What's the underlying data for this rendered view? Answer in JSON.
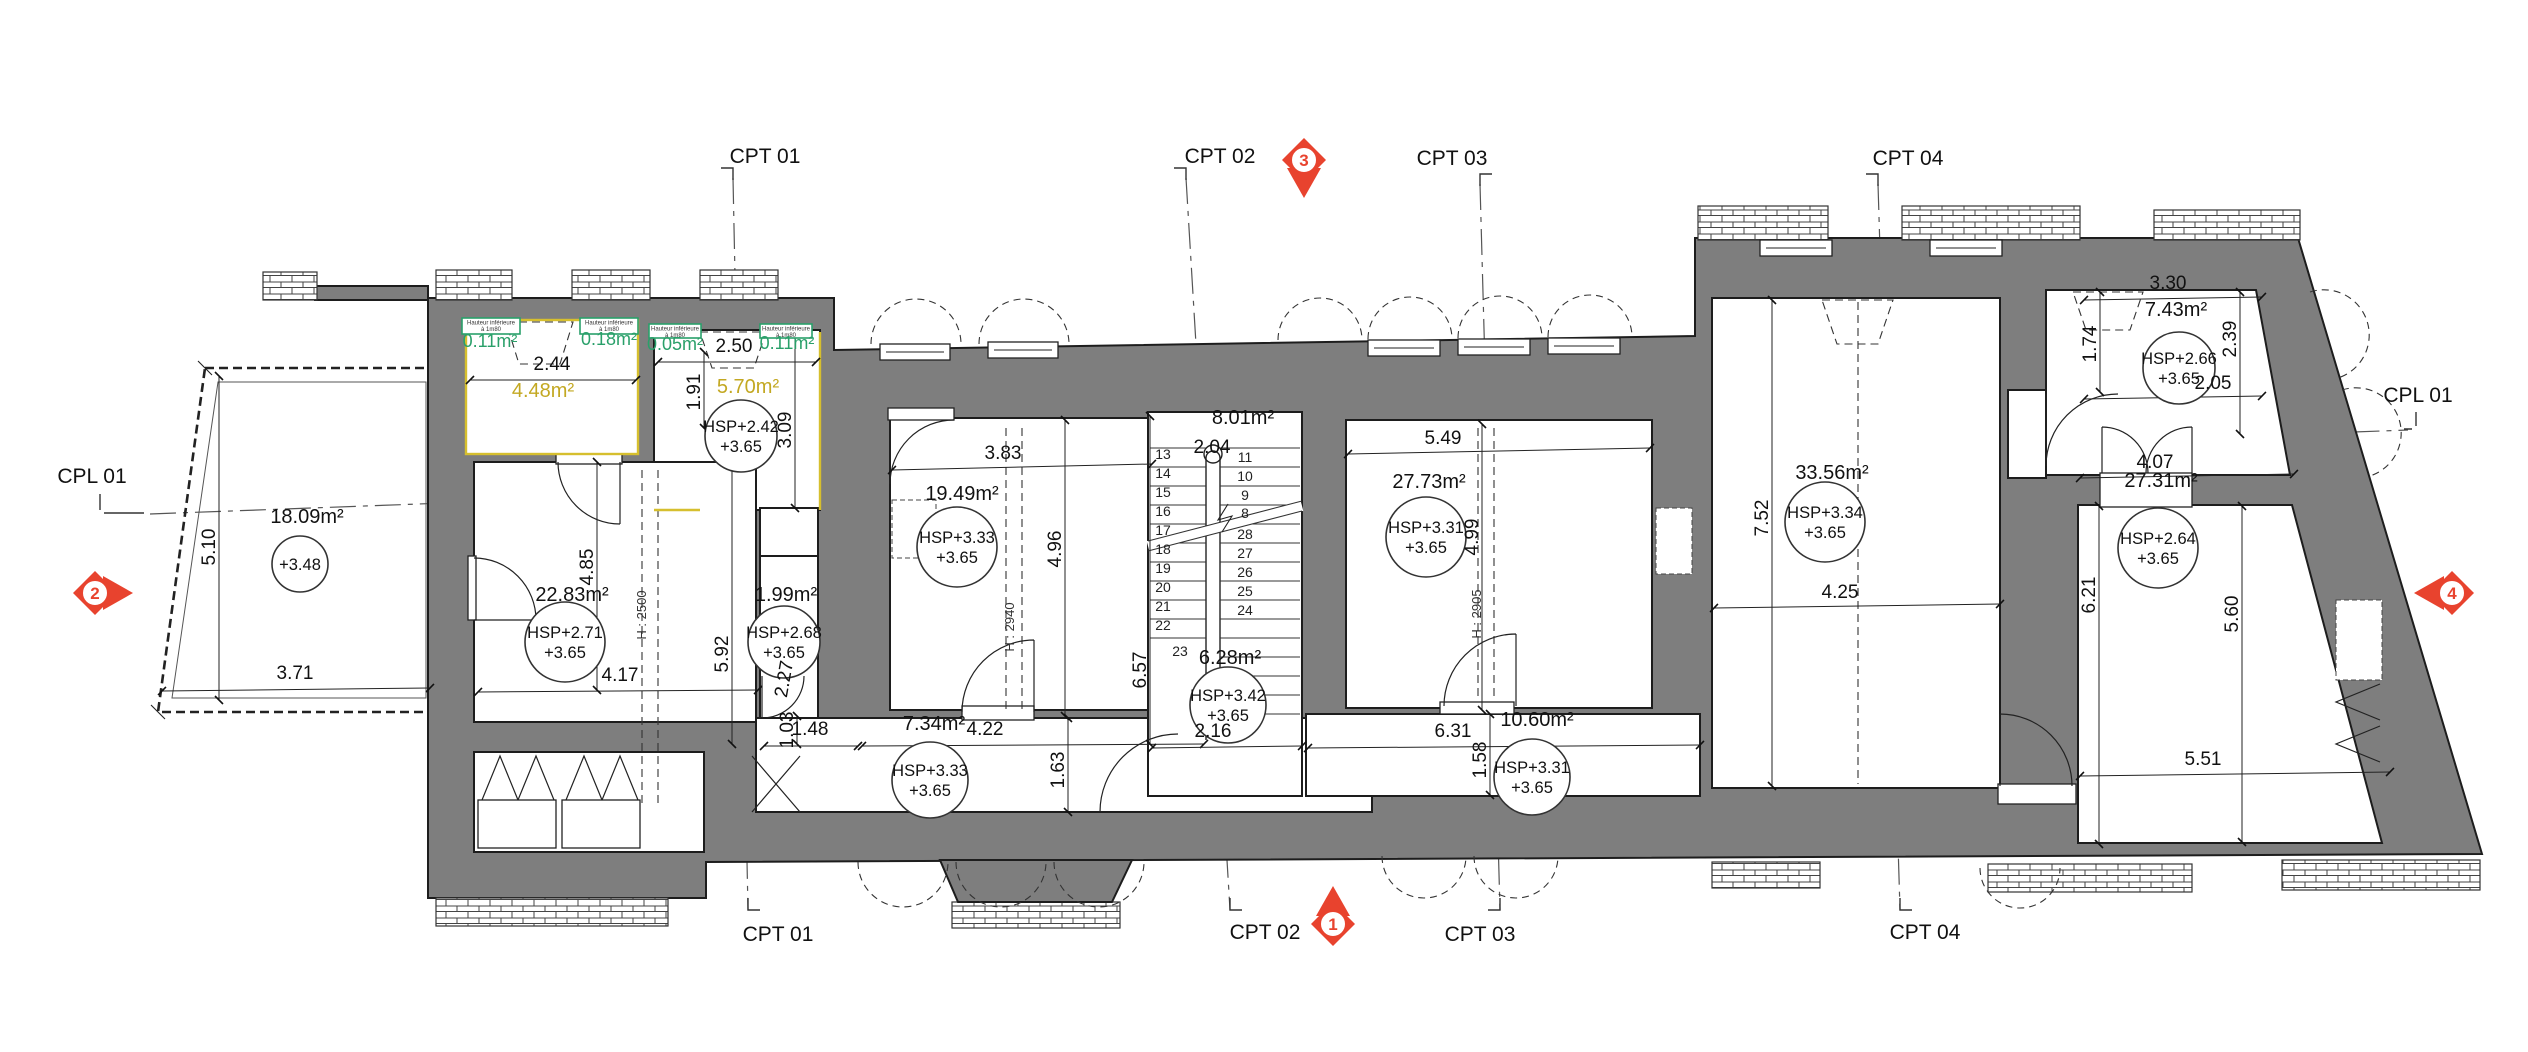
{
  "palette": {
    "wall_gray": "#7e7e7e",
    "line_dark": "#1d1d1d",
    "highlight_yellow": "#d6bf2e",
    "highlight_green": "#2aa06a",
    "marker_red": "#e8432e"
  },
  "green_box_note": {
    "line1": "Hauteur inférieure",
    "line2": "à 1m80"
  },
  "green_boxes": [
    {
      "x": 462,
      "y": 318,
      "w": 58,
      "h": 16,
      "area": "0.11m²",
      "ax": 490,
      "ay": 347
    },
    {
      "x": 580,
      "y": 318,
      "w": 58,
      "h": 16,
      "area": "0.18m²",
      "ax": 609,
      "ay": 345
    },
    {
      "x": 649,
      "y": 324,
      "w": 52,
      "h": 14,
      "area": "0.05m²",
      "ax": 675,
      "ay": 350
    },
    {
      "x": 760,
      "y": 324,
      "w": 52,
      "h": 14,
      "area": "0.11m²",
      "ax": 787,
      "ay": 349
    }
  ],
  "level_markers": [
    {
      "a": "HSP+2.42",
      "b": "+3.65",
      "x": 741,
      "y": 436,
      "r": 36
    },
    {
      "a": "HSP+2.71",
      "b": "+3.65",
      "x": 565,
      "y": 642,
      "r": 40
    },
    {
      "a": "HSP+2.68",
      "b": "+3.65",
      "x": 784,
      "y": 642,
      "r": 36
    },
    {
      "a": "HSP+3.33",
      "b": "+3.65",
      "x": 957,
      "y": 547,
      "r": 40
    },
    {
      "a": "HSP+3.33",
      "b": "+3.65",
      "x": 930,
      "y": 780,
      "r": 38
    },
    {
      "a": "HSP+3.42",
      "b": "+3.65",
      "x": 1228,
      "y": 705,
      "r": 38
    },
    {
      "a": "HSP+3.31",
      "b": "+3.65",
      "x": 1426,
      "y": 537,
      "r": 40
    },
    {
      "a": "HSP+3.31",
      "b": "+3.65",
      "x": 1532,
      "y": 777,
      "r": 38
    },
    {
      "a": "HSP+3.34",
      "b": "+3.65",
      "x": 1825,
      "y": 522,
      "r": 40
    },
    {
      "a": "HSP+2.66",
      "b": "+3.65",
      "x": 2179,
      "y": 368,
      "r": 36
    },
    {
      "a": "HSP+2.64",
      "b": "+3.65",
      "x": 2158,
      "y": 548,
      "r": 40
    },
    {
      "a": "+3.48",
      "b": "",
      "x": 300,
      "y": 564,
      "r": 28
    }
  ],
  "red_markers": [
    {
      "n": "3",
      "x": 1304,
      "y": 160,
      "dir": "down"
    },
    {
      "n": "1",
      "x": 1333,
      "y": 924,
      "dir": "up"
    },
    {
      "n": "2",
      "x": 95,
      "y": 593,
      "dir": "right"
    },
    {
      "n": "4",
      "x": 2452,
      "y": 593,
      "dir": "left"
    }
  ],
  "texts": [
    {
      "t": "CPT 01",
      "x": 765,
      "y": 163,
      "c": "grid"
    },
    {
      "t": "CPT 02",
      "x": 1220,
      "y": 163,
      "c": "grid"
    },
    {
      "t": "CPT 03",
      "x": 1452,
      "y": 165,
      "c": "grid"
    },
    {
      "t": "CPT 04",
      "x": 1908,
      "y": 165,
      "c": "grid"
    },
    {
      "t": "CPT 01",
      "x": 778,
      "y": 941,
      "c": "grid"
    },
    {
      "t": "CPT 02",
      "x": 1265,
      "y": 939,
      "c": "grid"
    },
    {
      "t": "CPT 03",
      "x": 1480,
      "y": 941,
      "c": "grid"
    },
    {
      "t": "CPT 04",
      "x": 1925,
      "y": 939,
      "c": "grid"
    },
    {
      "t": "CPL 01",
      "x": 92,
      "y": 483,
      "c": "grid"
    },
    {
      "t": "CPL 01",
      "x": 2418,
      "y": 402,
      "c": "grid"
    },
    {
      "t": "18.09m²",
      "x": 307,
      "y": 523,
      "c": "area"
    },
    {
      "t": "22.83m²",
      "x": 572,
      "y": 601,
      "c": "area"
    },
    {
      "t": "1.99m²",
      "x": 786,
      "y": 601,
      "c": "area"
    },
    {
      "t": "19.49m²",
      "x": 962,
      "y": 500,
      "c": "area"
    },
    {
      "t": "7.34m²",
      "x": 934,
      "y": 730,
      "c": "area"
    },
    {
      "t": "8.01m²",
      "x": 1243,
      "y": 424,
      "c": "area"
    },
    {
      "t": "6.28m²",
      "x": 1230,
      "y": 664,
      "c": "area"
    },
    {
      "t": "27.73m²",
      "x": 1429,
      "y": 488,
      "c": "area"
    },
    {
      "t": "10.60m²",
      "x": 1537,
      "y": 726,
      "c": "area"
    },
    {
      "t": "33.56m²",
      "x": 1832,
      "y": 479,
      "c": "area"
    },
    {
      "t": "7.43m²",
      "x": 2176,
      "y": 316,
      "c": "area"
    },
    {
      "t": "27.31m²",
      "x": 2161,
      "y": 487,
      "c": "area"
    },
    {
      "t": "4.48m²",
      "x": 543,
      "y": 397,
      "c": "areaY"
    },
    {
      "t": "5.70m²",
      "x": 748,
      "y": 393,
      "c": "areaY"
    },
    {
      "t": "2.44",
      "x": 552,
      "y": 370,
      "c": "dim"
    },
    {
      "t": "2.50",
      "x": 734,
      "y": 352,
      "c": "dim"
    },
    {
      "t": "1.91",
      "x": 700,
      "y": 392,
      "c": "dim",
      "r": -90
    },
    {
      "t": "3.09",
      "x": 791,
      "y": 430,
      "c": "dim",
      "r": -90
    },
    {
      "t": "2.04",
      "x": 1212,
      "y": 453,
      "c": "dim"
    },
    {
      "t": "3.83",
      "x": 1003,
      "y": 459,
      "c": "dim"
    },
    {
      "t": "5.49",
      "x": 1443,
      "y": 444,
      "c": "dim"
    },
    {
      "t": "4.17",
      "x": 620,
      "y": 681,
      "c": "dim"
    },
    {
      "t": "4.85",
      "x": 593,
      "y": 567,
      "c": "dim",
      "r": -90
    },
    {
      "t": "5.92",
      "x": 728,
      "y": 654,
      "c": "dim",
      "r": -90
    },
    {
      "t": "4.96",
      "x": 1061,
      "y": 549,
      "c": "dim",
      "r": -90
    },
    {
      "t": "4.99",
      "x": 1478,
      "y": 537,
      "c": "dim",
      "r": -90
    },
    {
      "t": "6.57",
      "x": 1146,
      "y": 670,
      "c": "dim",
      "r": -90
    },
    {
      "t": "7.52",
      "x": 1768,
      "y": 518,
      "c": "dim",
      "r": -90
    },
    {
      "t": "4.25",
      "x": 1840,
      "y": 598,
      "c": "dim"
    },
    {
      "t": "6.21",
      "x": 2095,
      "y": 595,
      "c": "dim",
      "r": -90
    },
    {
      "t": "5.60",
      "x": 2238,
      "y": 614,
      "c": "dim",
      "r": -90
    },
    {
      "t": "1.74",
      "x": 2096,
      "y": 344,
      "c": "dim",
      "r": -90
    },
    {
      "t": "2.39",
      "x": 2236,
      "y": 339,
      "c": "dim",
      "r": -90
    },
    {
      "t": "2.05",
      "x": 2213,
      "y": 389,
      "c": "dim"
    },
    {
      "t": "3.30",
      "x": 2168,
      "y": 289,
      "c": "dim"
    },
    {
      "t": "4.07",
      "x": 2155,
      "y": 468,
      "c": "dim"
    },
    {
      "t": "5.51",
      "x": 2203,
      "y": 765,
      "c": "dim"
    },
    {
      "t": "3.71",
      "x": 295,
      "y": 679,
      "c": "dim"
    },
    {
      "t": "5.10",
      "x": 215,
      "y": 547,
      "c": "dim",
      "r": -90
    },
    {
      "t": "4.22",
      "x": 985,
      "y": 735,
      "c": "dim"
    },
    {
      "t": "1.48",
      "x": 810,
      "y": 735,
      "c": "dim"
    },
    {
      "t": "1.63",
      "x": 1064,
      "y": 770,
      "c": "dim",
      "r": -90
    },
    {
      "t": "1.03",
      "x": 793,
      "y": 730,
      "c": "dim",
      "r": -90
    },
    {
      "t": "2.27",
      "x": 790,
      "y": 680,
      "c": "dim",
      "r": -80
    },
    {
      "t": "6.31",
      "x": 1453,
      "y": 737,
      "c": "dim"
    },
    {
      "t": "1.58",
      "x": 1486,
      "y": 760,
      "c": "dim",
      "r": -90
    },
    {
      "t": "2.16",
      "x": 1213,
      "y": 737,
      "c": "dim"
    },
    {
      "t": "H : 2500",
      "x": 646,
      "y": 615,
      "c": "tiny",
      "r": -90
    },
    {
      "t": "H : 2940",
      "x": 1014,
      "y": 627,
      "c": "tiny",
      "r": -90
    },
    {
      "t": "H : 2905",
      "x": 1481,
      "y": 614,
      "c": "tiny",
      "r": -90
    },
    {
      "t": "13",
      "x": 1163,
      "y": 459,
      "c": "stair"
    },
    {
      "t": "14",
      "x": 1163,
      "y": 478,
      "c": "stair"
    },
    {
      "t": "15",
      "x": 1163,
      "y": 497,
      "c": "stair"
    },
    {
      "t": "16",
      "x": 1163,
      "y": 516,
      "c": "stair"
    },
    {
      "t": "17",
      "x": 1163,
      "y": 535,
      "c": "stair"
    },
    {
      "t": "18",
      "x": 1163,
      "y": 554,
      "c": "stair"
    },
    {
      "t": "19",
      "x": 1163,
      "y": 573,
      "c": "stair"
    },
    {
      "t": "20",
      "x": 1163,
      "y": 592,
      "c": "stair"
    },
    {
      "t": "21",
      "x": 1163,
      "y": 611,
      "c": "stair"
    },
    {
      "t": "22",
      "x": 1163,
      "y": 630,
      "c": "stair"
    },
    {
      "t": "23",
      "x": 1180,
      "y": 656,
      "c": "stair"
    },
    {
      "t": "11",
      "x": 1245,
      "y": 462,
      "c": "stair"
    },
    {
      "t": "10",
      "x": 1245,
      "y": 481,
      "c": "stair"
    },
    {
      "t": "9",
      "x": 1245,
      "y": 500,
      "c": "stair"
    },
    {
      "t": "8",
      "x": 1245,
      "y": 518,
      "c": "stair"
    },
    {
      "t": "28",
      "x": 1245,
      "y": 539,
      "c": "stair"
    },
    {
      "t": "27",
      "x": 1245,
      "y": 558,
      "c": "stair"
    },
    {
      "t": "26",
      "x": 1245,
      "y": 577,
      "c": "stair"
    },
    {
      "t": "25",
      "x": 1245,
      "y": 596,
      "c": "stair"
    },
    {
      "t": "24",
      "x": 1245,
      "y": 615,
      "c": "stair"
    }
  ]
}
